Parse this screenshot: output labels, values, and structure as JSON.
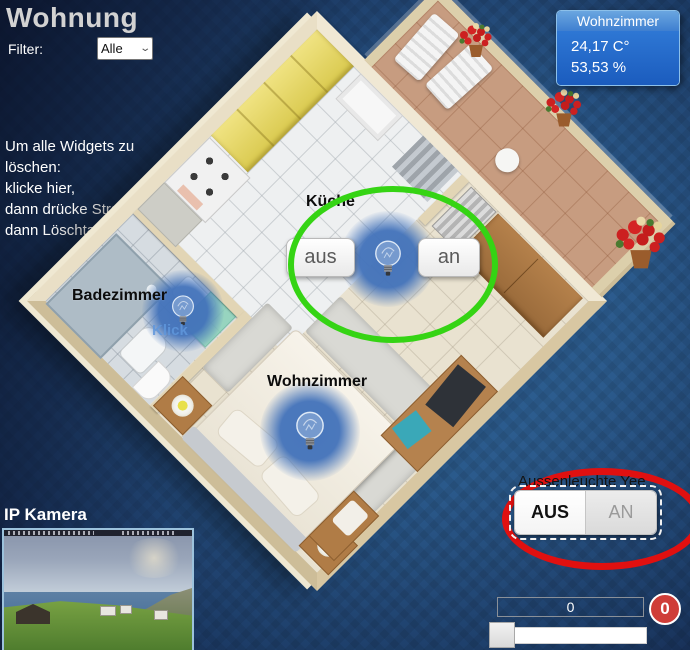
{
  "window": {
    "title": "Wohnung"
  },
  "filter": {
    "label": "Filter:",
    "value": "Alle"
  },
  "instructions": {
    "lines": [
      "Um alle Widgets zu",
      "löschen:",
      "klicke hier,",
      "dann drücke Strg+A and",
      "dann Löschtaste"
    ]
  },
  "sensor_panel": {
    "title": "Wohnzimmer",
    "temperature": "24,17 C°",
    "humidity": "53,53 %"
  },
  "rooms": {
    "kitchen": {
      "label": "Küche",
      "off_button": "aus",
      "on_button": "an"
    },
    "bathroom": {
      "label": "Badezimmer",
      "hint": "Klick"
    },
    "living": {
      "label": "Wohnzimmer"
    }
  },
  "outdoor_light": {
    "label": "Aussenleuchte Yee",
    "off_button": "AUS",
    "on_button": "AN",
    "state": "AUS"
  },
  "camera": {
    "label": "IP Kamera"
  },
  "numeric_widget": {
    "value": "0",
    "badge": "0"
  },
  "slider": {
    "value": "0"
  },
  "colors": {
    "annotation_green": "#35d414",
    "annotation_red": "#e01010",
    "panel_blue": "#1f64c8",
    "badge_red": "#cf3d38",
    "bulb_glow_blue": "#4272ba",
    "wall_beige": "#e2d5b5"
  }
}
